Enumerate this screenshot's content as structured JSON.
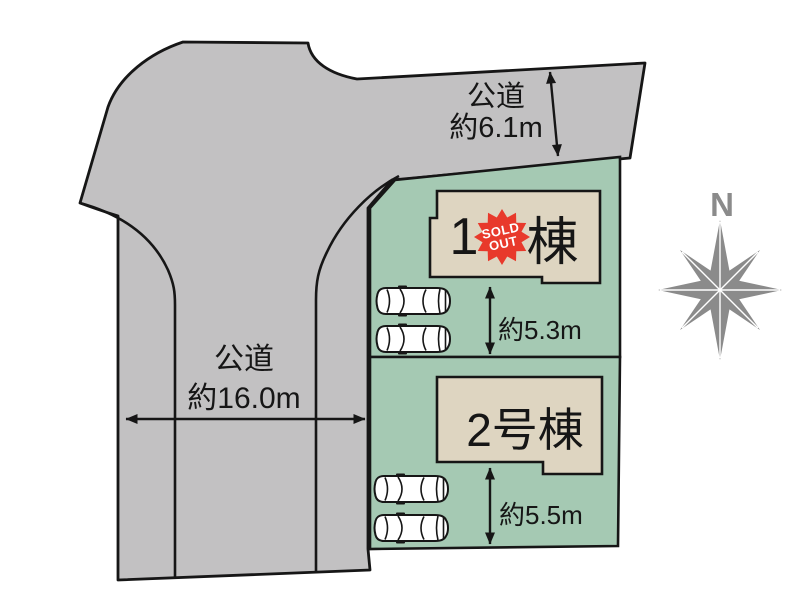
{
  "roads": {
    "top": {
      "name": "公道",
      "width": "約6.1m"
    },
    "left": {
      "name": "公道",
      "width": "約16.0m"
    }
  },
  "plots": [
    {
      "building_prefix": "1",
      "building_suffix": "棟",
      "badge": {
        "line1": "SOLD",
        "line2": "OUT"
      },
      "depth": "約5.3m"
    },
    {
      "building": "2号棟",
      "depth": "約5.5m"
    }
  ],
  "compass": {
    "north": "N"
  },
  "colors": {
    "road": "#c2c1c2",
    "plot": "#a5c9b3",
    "building": "#ded5c1",
    "badge": "#e8392b",
    "outline": "#161616",
    "compass": "#8b8b8b"
  }
}
